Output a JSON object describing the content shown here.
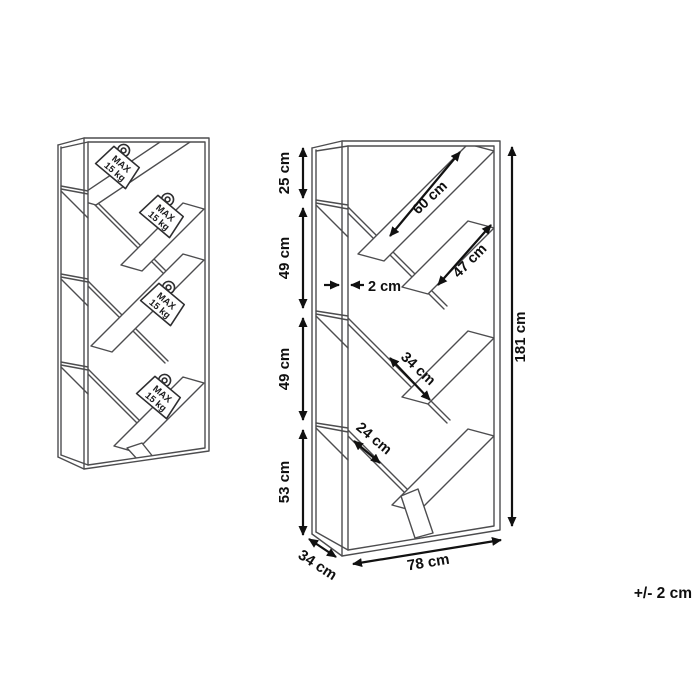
{
  "figure_left": {
    "weight_tags": [
      {
        "line1": "MAX",
        "line2": "15 kg"
      },
      {
        "line1": "MAX",
        "line2": "15 kg"
      },
      {
        "line1": "MAX",
        "line2": "15 kg"
      },
      {
        "line1": "MAX",
        "line2": "15 kg"
      }
    ]
  },
  "figure_right": {
    "left_sections": [
      {
        "label": "25 cm"
      },
      {
        "label": "49 cm"
      },
      {
        "label": "49 cm"
      },
      {
        "label": "53 cm"
      }
    ],
    "frame_thickness": {
      "label": "2 cm"
    },
    "shelf_lengths": [
      {
        "label": "60 cm"
      },
      {
        "label": "47 cm"
      },
      {
        "label": "34 cm"
      },
      {
        "label": "24 cm"
      }
    ],
    "total_height": {
      "label": "181 cm"
    },
    "depth": {
      "label": "34 cm"
    },
    "width": {
      "label": "78 cm"
    }
  },
  "footnote": {
    "tolerance": "+/- 2 cm"
  },
  "colors": {
    "structure_line": "#4d4d4f",
    "dimension_line": "#111111",
    "background": "#ffffff"
  }
}
